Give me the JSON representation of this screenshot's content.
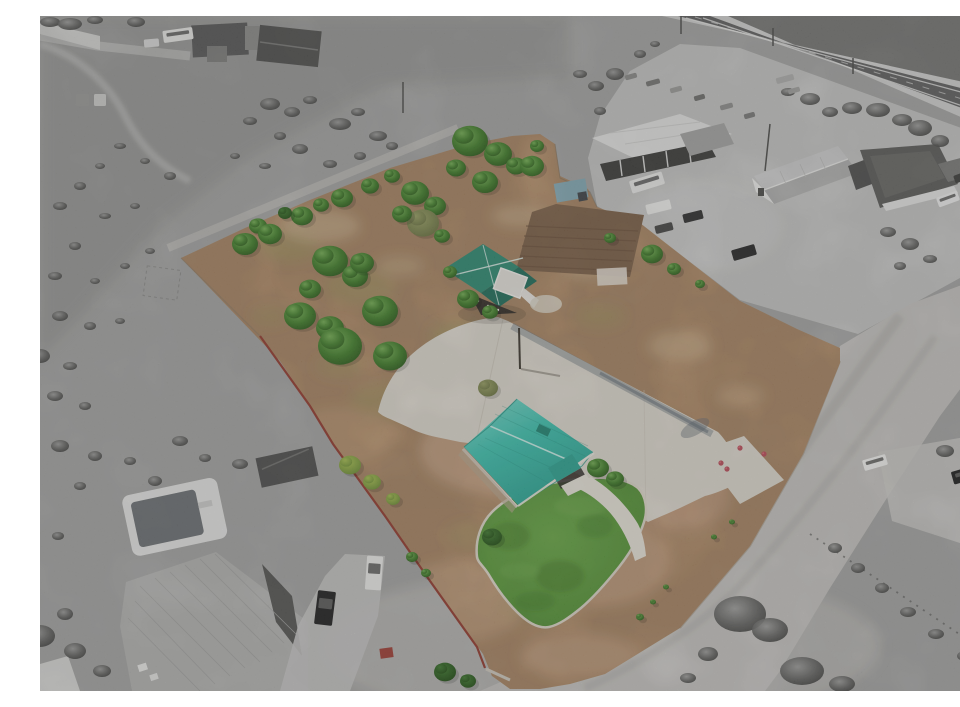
{
  "meta": {
    "type": "aerial-photograph",
    "description": "Aerial drone photo of a rural property listing: the featured lot is shown in color (tan dirt field with green trees, a teal-roofed house with green lawn and large concrete driveway, a teal-roofed barn, red west fence) while all surrounding land, roads, commercial buildings and neighboring houses are desaturated gray."
  },
  "palette": {
    "scrub_gray": "#a5a5a3",
    "scrub_dark": "#8e8e8c",
    "parking_gray": "#c6c6c4",
    "road_gray": "#c7c5c1",
    "road_shoulder": "#d3d3d1",
    "asphalt_dark": "#5f5f5f",
    "dark_field": "#757573",
    "concrete": "#dfdacf",
    "concrete_bright": "#eae5da",
    "lot_tan": "#c69c73",
    "lot_tan_light": "#dcc19c",
    "tilled_brown": "#7c5f46",
    "lawn_green": "#5d9e3c",
    "lawn_dark": "#3a7022",
    "roof_teal": "#3cc3b0",
    "roof_teal_light": "#7ddcce",
    "roof_teal_dark": "#27a18e",
    "shed_green": "#2e8a72",
    "shed_green_dark": "#1f6e59",
    "blue_shed": "#84aab6",
    "fence_red": "#93392c",
    "rose_red": "#bb4a58",
    "tree_gray": "#565654",
    "white_struct": "#ebebe9",
    "dark_roof": "#565656",
    "metal_roof": "#b4b4b2",
    "pool_water": "#6d7174",
    "shadow": "#6e7880"
  },
  "scene": {
    "trees_green": [
      [
        430,
        125,
        18,
        0
      ],
      [
        458,
        138,
        14,
        0
      ],
      [
        476,
        150,
        10,
        0
      ],
      [
        497,
        130,
        7,
        0
      ],
      [
        492,
        150,
        12,
        0
      ],
      [
        445,
        166,
        13,
        0
      ],
      [
        416,
        152,
        10,
        0
      ],
      [
        205,
        228,
        13,
        0
      ],
      [
        218,
        210,
        9,
        0
      ],
      [
        230,
        218,
        12,
        0
      ],
      [
        262,
        200,
        11,
        0
      ],
      [
        281,
        189,
        8,
        0
      ],
      [
        302,
        182,
        11,
        0
      ],
      [
        330,
        170,
        9,
        0
      ],
      [
        352,
        160,
        8,
        0
      ],
      [
        375,
        177,
        14,
        0
      ],
      [
        395,
        190,
        11,
        0
      ],
      [
        383,
        207,
        16,
        3
      ],
      [
        362,
        198,
        10,
        0
      ],
      [
        402,
        220,
        8,
        0
      ],
      [
        290,
        245,
        18,
        0
      ],
      [
        315,
        260,
        13,
        0
      ],
      [
        245,
        197,
        7,
        1
      ],
      [
        270,
        273,
        11,
        0
      ],
      [
        322,
        247,
        12,
        0
      ],
      [
        260,
        300,
        16,
        0
      ],
      [
        290,
        312,
        14,
        0
      ],
      [
        340,
        295,
        18,
        0
      ],
      [
        300,
        330,
        22,
        0
      ],
      [
        350,
        340,
        17,
        0
      ],
      [
        310,
        449,
        11,
        2
      ],
      [
        332,
        466,
        9,
        2
      ],
      [
        353,
        483,
        7,
        2
      ],
      [
        372,
        541,
        6,
        0
      ],
      [
        386,
        557,
        5,
        0
      ],
      [
        428,
        283,
        11,
        0
      ],
      [
        450,
        296,
        8,
        0
      ],
      [
        410,
        256,
        7,
        0
      ],
      [
        612,
        238,
        11,
        0
      ],
      [
        634,
        253,
        7,
        0
      ],
      [
        660,
        268,
        5,
        0
      ],
      [
        570,
        222,
        6,
        0
      ],
      [
        448,
        372,
        10,
        3
      ],
      [
        558,
        452,
        11,
        0
      ],
      [
        575,
        463,
        9,
        0
      ],
      [
        452,
        521,
        10,
        1
      ],
      [
        405,
        656,
        11,
        1
      ],
      [
        428,
        665,
        8,
        1
      ],
      [
        600,
        601,
        4,
        0
      ],
      [
        613,
        586,
        3,
        0
      ],
      [
        626,
        571,
        3,
        0
      ],
      [
        674,
        521,
        3,
        0
      ],
      [
        692,
        506,
        3,
        0
      ]
    ],
    "trees_gray": [
      [
        10,
        6,
        10,
        5
      ],
      [
        30,
        8,
        12,
        6
      ],
      [
        55,
        4,
        8,
        4
      ],
      [
        96,
        6,
        9,
        5
      ],
      [
        230,
        88,
        10,
        6
      ],
      [
        252,
        96,
        8,
        5
      ],
      [
        270,
        84,
        7,
        4
      ],
      [
        300,
        108,
        11,
        6
      ],
      [
        318,
        96,
        7,
        4
      ],
      [
        338,
        120,
        9,
        5
      ],
      [
        240,
        120,
        6,
        4
      ],
      [
        210,
        105,
        7,
        4
      ],
      [
        260,
        133,
        8,
        5
      ],
      [
        290,
        148,
        7,
        4
      ],
      [
        225,
        150,
        6,
        3
      ],
      [
        195,
        140,
        5,
        3
      ],
      [
        320,
        140,
        6,
        4
      ],
      [
        352,
        130,
        6,
        4
      ],
      [
        130,
        160,
        6,
        4
      ],
      [
        105,
        145,
        5,
        3
      ],
      [
        80,
        130,
        6,
        3
      ],
      [
        60,
        150,
        5,
        3
      ],
      [
        40,
        170,
        6,
        4
      ],
      [
        20,
        190,
        7,
        4
      ],
      [
        65,
        200,
        6,
        3
      ],
      [
        95,
        190,
        5,
        3
      ],
      [
        35,
        230,
        6,
        4
      ],
      [
        15,
        260,
        7,
        4
      ],
      [
        55,
        265,
        5,
        3
      ],
      [
        85,
        250,
        5,
        3
      ],
      [
        110,
        235,
        5,
        3
      ],
      [
        20,
        300,
        8,
        5
      ],
      [
        50,
        310,
        6,
        4
      ],
      [
        80,
        305,
        5,
        3
      ],
      [
        0,
        340,
        10,
        7
      ],
      [
        30,
        350,
        7,
        4
      ],
      [
        15,
        380,
        8,
        5
      ],
      [
        45,
        390,
        6,
        4
      ],
      [
        20,
        430,
        9,
        6
      ],
      [
        55,
        440,
        7,
        5
      ],
      [
        90,
        445,
        6,
        4
      ],
      [
        115,
        465,
        7,
        5
      ],
      [
        40,
        470,
        6,
        4
      ],
      [
        18,
        520,
        6,
        4
      ],
      [
        140,
        425,
        8,
        5
      ],
      [
        165,
        442,
        6,
        4
      ],
      [
        200,
        448,
        8,
        5
      ],
      [
        0,
        620,
        15,
        11
      ],
      [
        35,
        635,
        11,
        8
      ],
      [
        25,
        598,
        8,
        6
      ],
      [
        62,
        655,
        9,
        6
      ],
      [
        700,
        598,
        26,
        18
      ],
      [
        730,
        614,
        18,
        12
      ],
      [
        668,
        638,
        10,
        7
      ],
      [
        762,
        655,
        22,
        14
      ],
      [
        802,
        668,
        13,
        8
      ],
      [
        648,
        662,
        8,
        5
      ],
      [
        880,
        112,
        12,
        8
      ],
      [
        900,
        125,
        9,
        6
      ],
      [
        862,
        104,
        10,
        6
      ],
      [
        838,
        94,
        12,
        7
      ],
      [
        812,
        92,
        10,
        6
      ],
      [
        930,
        190,
        8,
        5
      ],
      [
        945,
        210,
        7,
        4
      ],
      [
        955,
        430,
        12,
        8
      ],
      [
        930,
        445,
        10,
        7
      ],
      [
        905,
        435,
        9,
        6
      ],
      [
        950,
        465,
        8,
        6
      ],
      [
        795,
        532,
        7,
        5
      ],
      [
        818,
        552,
        7,
        5
      ],
      [
        842,
        572,
        7,
        5
      ],
      [
        868,
        596,
        8,
        5
      ],
      [
        896,
        618,
        8,
        5
      ],
      [
        925,
        640,
        8,
        5
      ],
      [
        950,
        658,
        8,
        5
      ],
      [
        575,
        58,
        9,
        6
      ],
      [
        556,
        70,
        8,
        5
      ],
      [
        540,
        58,
        7,
        4
      ],
      [
        600,
        38,
        6,
        4
      ],
      [
        615,
        28,
        5,
        3
      ],
      [
        560,
        95,
        6,
        4
      ],
      [
        770,
        83,
        10,
        6
      ],
      [
        790,
        96,
        8,
        5
      ],
      [
        748,
        76,
        7,
        4
      ],
      [
        870,
        228,
        9,
        6
      ],
      [
        848,
        216,
        8,
        5
      ],
      [
        890,
        243,
        7,
        4
      ],
      [
        860,
        250,
        6,
        4
      ]
    ],
    "patches": [
      [
        250,
        230,
        30,
        16,
        "#99a055",
        0.3
      ],
      [
        320,
        270,
        35,
        18,
        "#99a055",
        0.28
      ],
      [
        420,
        320,
        30,
        15,
        "#9aa259",
        0.3
      ],
      [
        350,
        385,
        40,
        18,
        "#9aa259",
        0.25
      ],
      [
        500,
        380,
        28,
        13,
        "#9aa259",
        0.25
      ],
      [
        560,
        300,
        24,
        11,
        "#99a055",
        0.25
      ],
      [
        620,
        420,
        32,
        16,
        "#9aa259",
        0.22
      ],
      [
        580,
        470,
        24,
        11,
        "#99a055",
        0.2
      ],
      [
        300,
        350,
        24,
        11,
        "#99a055",
        0.25
      ],
      [
        430,
        520,
        24,
        13,
        "#9aa259",
        0.2
      ],
      [
        480,
        590,
        28,
        14,
        "#9aa259",
        0.22
      ],
      [
        230,
        300,
        18,
        9,
        "#99a055",
        0.25
      ],
      [
        280,
        210,
        40,
        16,
        "#dcc5a0",
        0.45
      ],
      [
        480,
        200,
        28,
        11,
        "#dcc5a0",
        0.4
      ],
      [
        550,
        250,
        28,
        13,
        "#d8c09a",
        0.4
      ],
      [
        640,
        330,
        32,
        15,
        "#d8bd96",
        0.45
      ],
      [
        700,
        380,
        24,
        11,
        "#daba92",
        0.4
      ],
      [
        360,
        250,
        24,
        10,
        "#d8c09a",
        0.35
      ],
      [
        470,
        435,
        90,
        45,
        "#dab398",
        0.5
      ],
      [
        560,
        545,
        70,
        45,
        "#d8b090",
        0.45
      ],
      [
        420,
        585,
        66,
        40,
        "#d5ae8e",
        0.4
      ],
      [
        640,
        480,
        50,
        35,
        "#dab398",
        0.35
      ],
      [
        540,
        640,
        60,
        22,
        "#d8b294",
        0.4
      ],
      [
        300,
        420,
        55,
        28,
        "#cfa87f",
        0.35
      ]
    ],
    "vehicles": [
      {
        "name": "camper-trailer",
        "x": 123,
        "y": 13,
        "w": 30,
        "h": 12,
        "rot": -8,
        "fill": "#e9e9e7",
        "glass": true
      },
      {
        "name": "car",
        "x": 104,
        "y": 23,
        "w": 15,
        "h": 8,
        "rot": -5,
        "fill": "#dcdcda",
        "glass": false
      },
      {
        "name": "pickup",
        "x": 36,
        "y": 78,
        "w": 13,
        "h": 12,
        "rot": 0,
        "fill": "#9b9b99",
        "glass": false
      },
      {
        "name": "pickup",
        "x": 54,
        "y": 78,
        "w": 12,
        "h": 12,
        "rot": 0,
        "fill": "#cfcfcd",
        "glass": false
      },
      {
        "name": "rv-trailer",
        "x": 590,
        "y": 160,
        "w": 34,
        "h": 13,
        "rot": -17,
        "fill": "#ececea",
        "glass": true
      },
      {
        "name": "storage-container",
        "x": 606,
        "y": 186,
        "w": 25,
        "h": 10,
        "rot": -14,
        "fill": "#efefed",
        "glass": false
      },
      {
        "name": "dark-car",
        "x": 643,
        "y": 196,
        "w": 20,
        "h": 9,
        "rot": -14,
        "fill": "#2e2e2e",
        "glass": false
      },
      {
        "name": "dark-car",
        "x": 615,
        "y": 208,
        "w": 18,
        "h": 8,
        "rot": -14,
        "fill": "#454543",
        "glass": false
      },
      {
        "name": "suv",
        "x": 692,
        "y": 231,
        "w": 24,
        "h": 11,
        "rot": -16,
        "fill": "#262626",
        "glass": false
      },
      {
        "name": "white-car",
        "x": 897,
        "y": 178,
        "w": 22,
        "h": 10,
        "rot": -20,
        "fill": "#f1f1ef",
        "glass": true
      },
      {
        "name": "dark-car",
        "x": 914,
        "y": 157,
        "w": 16,
        "h": 8,
        "rot": -20,
        "fill": "#3a3a38",
        "glass": false
      },
      {
        "name": "white-car",
        "x": 823,
        "y": 441,
        "w": 24,
        "h": 11,
        "rot": -16,
        "fill": "#f3f3f1",
        "glass": true
      },
      {
        "name": "black-suv",
        "x": 912,
        "y": 452,
        "w": 28,
        "h": 13,
        "rot": -16,
        "fill": "#1c1c1c",
        "glass": true
      },
      {
        "name": "black-car",
        "x": 276,
        "y": 575,
        "w": 18,
        "h": 34,
        "rot": 7,
        "fill": "#1e1e1e",
        "glass": true
      },
      {
        "name": "white-car",
        "x": 326,
        "y": 540,
        "w": 16,
        "h": 34,
        "rot": 4,
        "fill": "#eeeeec",
        "glass": true
      },
      {
        "name": "roadside-trailer",
        "x": 585,
        "y": 58,
        "w": 12,
        "h": 5,
        "rot": -15,
        "fill": "#8a8a88",
        "glass": false
      },
      {
        "name": "roadside-trailer",
        "x": 606,
        "y": 64,
        "w": 14,
        "h": 5,
        "rot": -15,
        "fill": "#757573",
        "glass": false
      },
      {
        "name": "roadside-trailer",
        "x": 630,
        "y": 71,
        "w": 12,
        "h": 5,
        "rot": -15,
        "fill": "#9b9b99",
        "glass": false
      },
      {
        "name": "roadside-trailer",
        "x": 654,
        "y": 79,
        "w": 11,
        "h": 5,
        "rot": -15,
        "fill": "#6f6f6d",
        "glass": false
      },
      {
        "name": "roadside-trailer",
        "x": 680,
        "y": 88,
        "w": 13,
        "h": 5,
        "rot": -15,
        "fill": "#8f8f8d",
        "glass": false
      },
      {
        "name": "roadside-trailer",
        "x": 704,
        "y": 97,
        "w": 11,
        "h": 5,
        "rot": -15,
        "fill": "#7a7a78",
        "glass": false
      },
      {
        "name": "flatbed",
        "x": 736,
        "y": 60,
        "w": 18,
        "h": 6,
        "rot": -15,
        "fill": "#b0b0ae",
        "glass": false
      },
      {
        "name": "roadside-trailer",
        "x": 748,
        "y": 72,
        "w": 12,
        "h": 5,
        "rot": -16,
        "fill": "#9e9e9c",
        "glass": false
      }
    ],
    "roses": [
      [
        681,
        447
      ],
      [
        687,
        453
      ],
      [
        724,
        438
      ],
      [
        700,
        432
      ]
    ],
    "poles": [
      [
        363,
        66,
        363,
        97
      ],
      [
        479,
        312,
        480,
        353
      ],
      [
        730,
        108,
        725,
        155
      ],
      [
        641,
        0,
        641,
        18
      ],
      [
        733,
        12,
        733,
        30
      ],
      [
        813,
        42,
        813,
        58
      ]
    ]
  }
}
